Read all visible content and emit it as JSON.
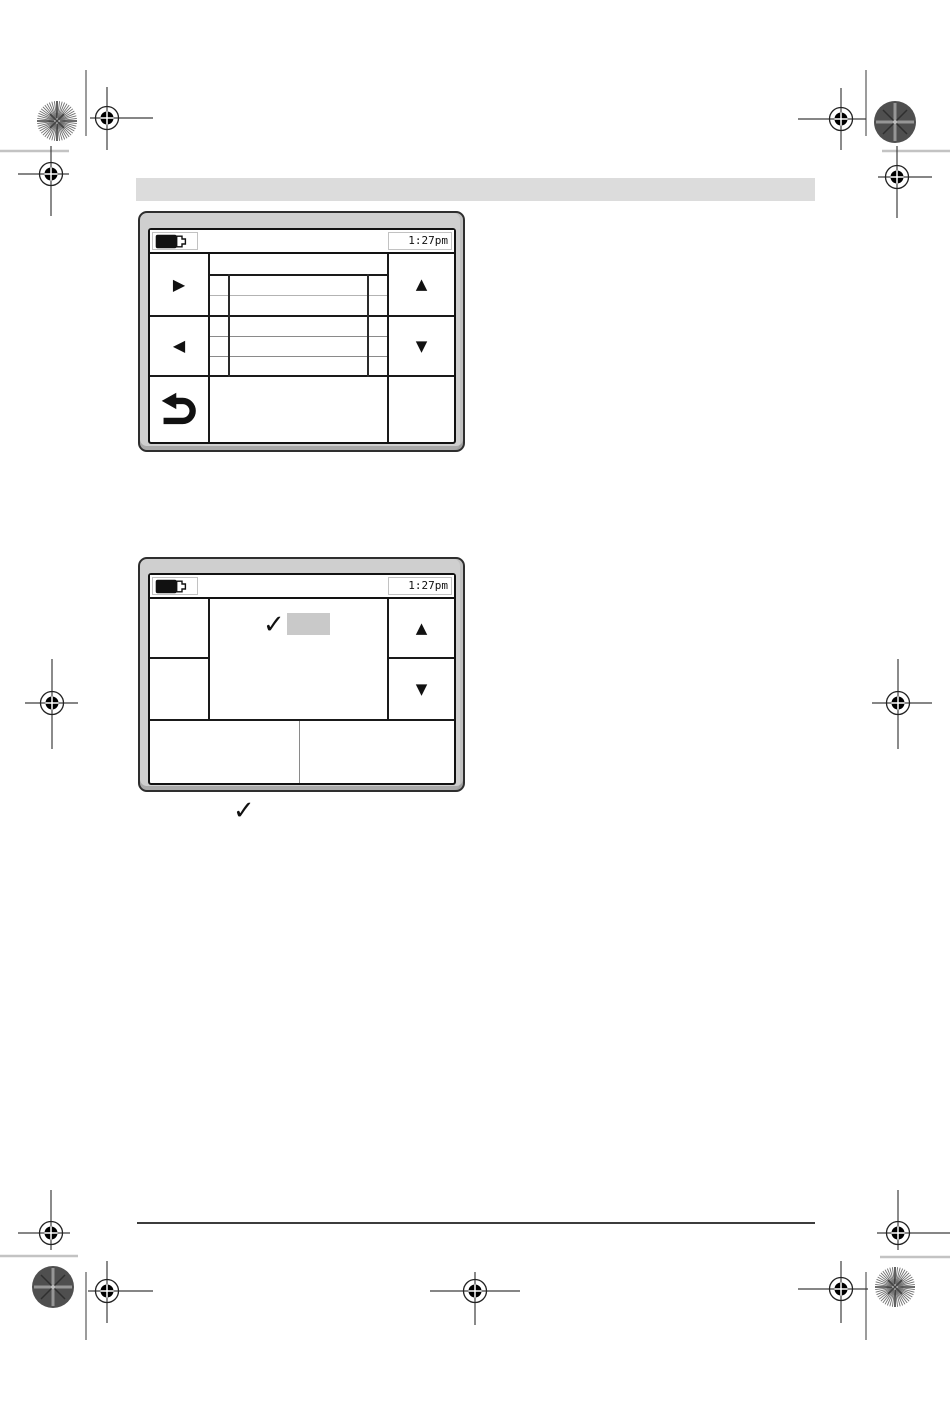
{
  "colors": {
    "bezel": "#cfcfcf",
    "header_bar": "#dcdcdc",
    "highlight": "#c9c9c9"
  },
  "header": {
    "bar_text": ""
  },
  "footnote": {
    "check_symbol": "✓"
  },
  "screen1": {
    "status": {
      "battery_icon": "battery-two-thirds-icon",
      "time": "1:27pm"
    },
    "buttons": {
      "play_symbol": "▶",
      "previous_symbol": "◀",
      "up_symbol": "▲",
      "down_symbol": "▼",
      "return_icon": "return-arrow-icon"
    },
    "list": {
      "row_count": 5,
      "rows": [
        "",
        "",
        "",
        "",
        ""
      ]
    }
  },
  "screen2": {
    "status": {
      "battery_icon": "battery-two-thirds-icon",
      "time": "1:27pm"
    },
    "buttons": {
      "up_symbol": "▲",
      "down_symbol": "▼"
    },
    "selection": {
      "check_symbol": "✓",
      "selected_item_text": ""
    }
  }
}
